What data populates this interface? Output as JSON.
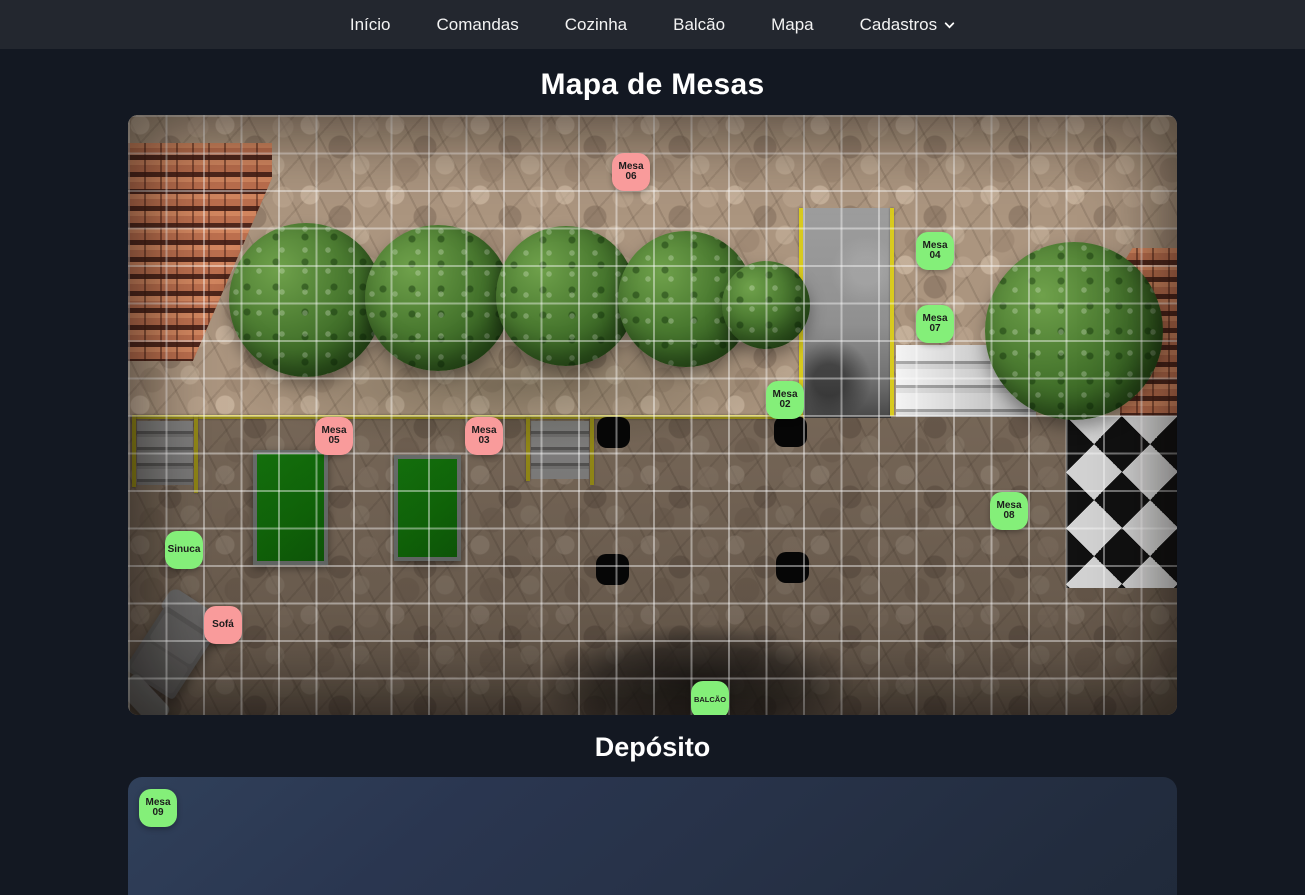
{
  "nav": {
    "items": [
      {
        "label": "Início"
      },
      {
        "label": "Comandas"
      },
      {
        "label": "Cozinha"
      },
      {
        "label": "Balcão"
      },
      {
        "label": "Mapa"
      }
    ],
    "dropdown": {
      "label": "Cadastros"
    }
  },
  "page": {
    "title": "Mapa de Mesas",
    "deposito_title": "Depósito"
  },
  "map": {
    "status_colors": {
      "free": "#84ef79",
      "busy": "#f99b9b"
    },
    "markers": [
      {
        "label": "Mesa 06",
        "state": "busy",
        "x": 484,
        "y": 38
      },
      {
        "label": "Mesa 04",
        "state": "free",
        "x": 788,
        "y": 117
      },
      {
        "label": "Mesa 07",
        "state": "free",
        "x": 788,
        "y": 190
      },
      {
        "label": "Mesa 02",
        "state": "free",
        "x": 638,
        "y": 266
      },
      {
        "label": "Mesa 05",
        "state": "busy",
        "x": 187,
        "y": 302
      },
      {
        "label": "Mesa 03",
        "state": "busy",
        "x": 337,
        "y": 302
      },
      {
        "label": "Mesa 08",
        "state": "free",
        "x": 862,
        "y": 377
      },
      {
        "label": "Sinuca",
        "state": "free",
        "x": 37,
        "y": 416
      },
      {
        "label": "Sofá",
        "state": "busy",
        "x": 76,
        "y": 491
      },
      {
        "label": "BALCÃO",
        "state": "free",
        "x": 563,
        "y": 566
      }
    ]
  },
  "deposito": {
    "markers": [
      {
        "label": "Mesa 09",
        "state": "free",
        "x": 11,
        "y": 12
      }
    ]
  }
}
